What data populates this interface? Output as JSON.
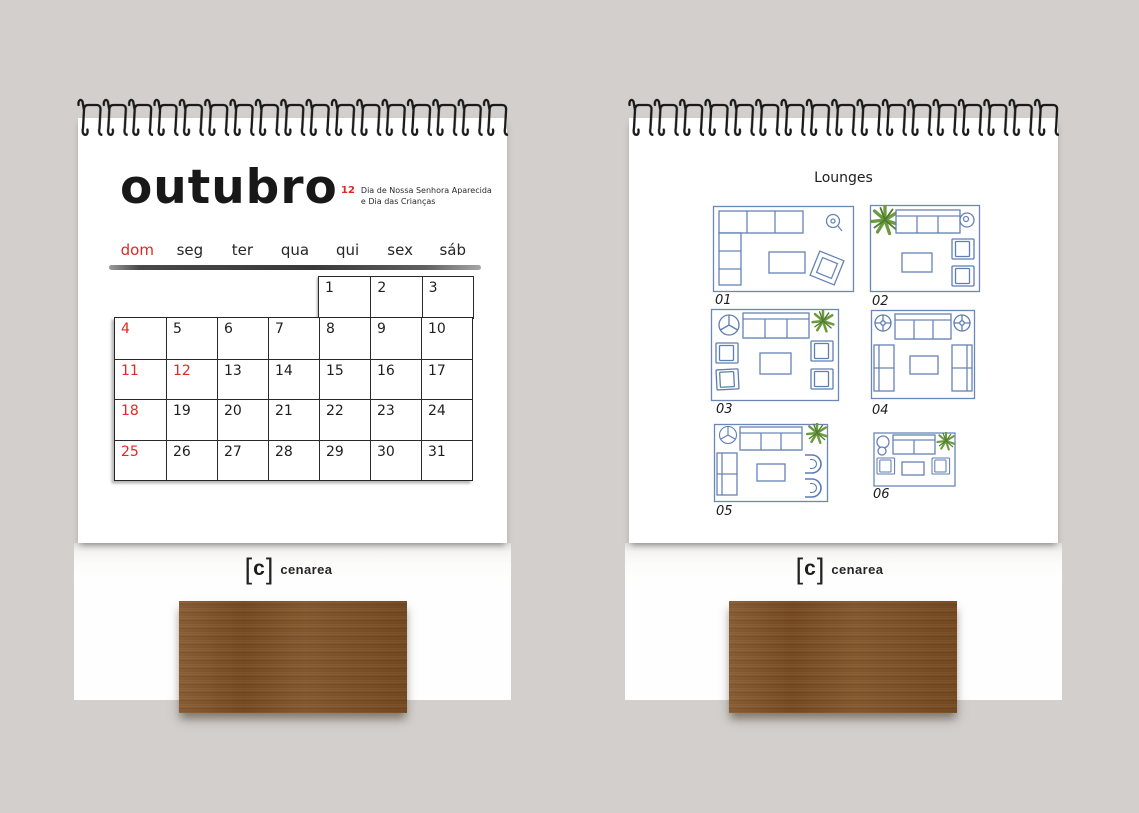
{
  "colors": {
    "background": "#d2cfcd",
    "page": "#ffffff",
    "accent_red": "#e02822",
    "ink": "#1c1c1c",
    "sketch_blue": "#5e7db2",
    "plant_green": "#6c9a3e",
    "wood_dark": "#6d441f",
    "wood_light": "#8a5a2e"
  },
  "brand": {
    "mark_open": "[",
    "mark_letter": "c",
    "mark_close": "]",
    "name": "cenarea"
  },
  "left_calendar": {
    "month_title": "outubro",
    "holiday_note": {
      "day": "12",
      "line1": "Dia de Nossa Senhora Aparecida",
      "line2": "e Dia das Crianças"
    },
    "weekdays": [
      "dom",
      "seg",
      "ter",
      "qua",
      "qui",
      "sex",
      "sáb"
    ],
    "grid": {
      "week1": [
        "1",
        "2",
        "3"
      ],
      "weeks": [
        [
          "4",
          "5",
          "6",
          "7",
          "8",
          "9",
          "10"
        ],
        [
          "11",
          "12",
          "13",
          "14",
          "15",
          "16",
          "17"
        ],
        [
          "18",
          "19",
          "20",
          "21",
          "22",
          "23",
          "24"
        ],
        [
          "25",
          "26",
          "27",
          "28",
          "29",
          "30",
          "31"
        ]
      ],
      "red_days": [
        "4",
        "11",
        "12",
        "18",
        "25"
      ]
    }
  },
  "right_calendar": {
    "title": "Lounges",
    "layout_labels": [
      "01",
      "02",
      "03",
      "04",
      "05",
      "06"
    ]
  }
}
